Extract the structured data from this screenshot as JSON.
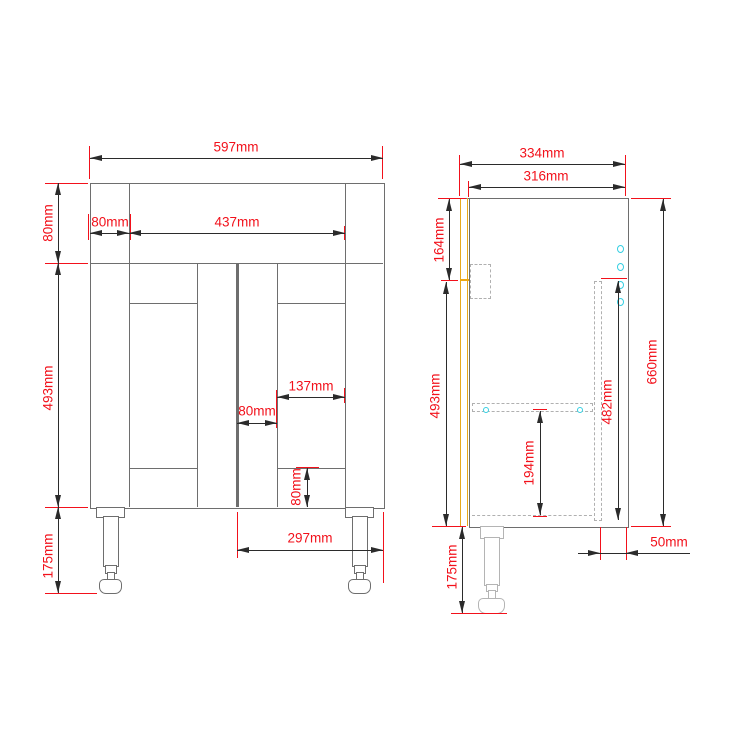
{
  "drawing": {
    "type": "cabinet technical drawing, front and side elevation",
    "colors": {
      "outline": "#6e6e6e",
      "dimension_line": "#2b2b2b",
      "dimension_text": "#f2111b",
      "extension_line": "#f2111b",
      "door_profile": "#e7a81c",
      "peg_holes": "#35cfe2",
      "hidden_lines": "#b0b0b0",
      "background": "#ffffff"
    },
    "front_view": {
      "total_width": "597mm",
      "top_rail_height": "80mm",
      "left_stile_width": "80mm",
      "top_rail_span": "437mm",
      "door_height": "493mm",
      "leg_height": "175mm",
      "door_panel_width": "137mm",
      "center_stile_width": "80mm",
      "bottom_rail_height": "80mm",
      "door_width": "297mm"
    },
    "side_view": {
      "total_depth": "334mm",
      "carcass_depth": "316mm",
      "top_section_height": "164mm",
      "door_height": "493mm",
      "total_height": "660mm",
      "back_panel_height": "482mm",
      "shelf_to_base_height": "194mm",
      "back_panel_offset": "50mm",
      "leg_height": "175mm"
    }
  }
}
